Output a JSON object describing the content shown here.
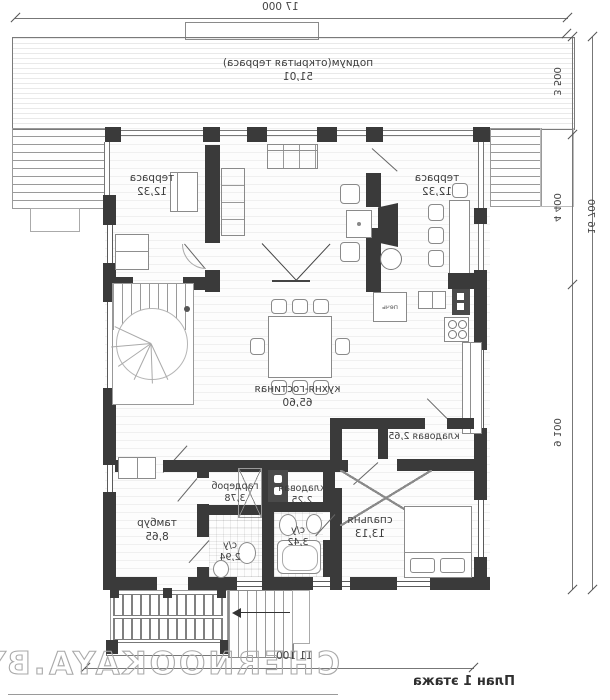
{
  "title": {
    "plan_label": "План 1 этажа"
  },
  "watermark": {
    "text": "CHERNOOKAYA.BY"
  },
  "dimensions": {
    "top_width": "17 000",
    "right_total": "16 700",
    "seg_podium": "3 500",
    "seg_terrace": "4 400",
    "seg_house": "9 100",
    "bottom_width": "11 100"
  },
  "rooms": {
    "podium": {
      "name": "подиум(открытая терраса)",
      "area": "51,01"
    },
    "terrace_left": {
      "name": "терраса",
      "area": "12,32"
    },
    "terrace_right": {
      "name": "терраса",
      "area": "12,32"
    },
    "kitchen_living": {
      "name": "кухня-гостиная",
      "area": "65,60"
    },
    "pantry_upper": {
      "name": "кладовая",
      "area": "2,65"
    },
    "bedroom": {
      "name": "спальня",
      "area": "13,13"
    },
    "pantry_small": {
      "name": "кладовая",
      "area": "2,25"
    },
    "bath_big": {
      "name": "с/у",
      "area": "3,42"
    },
    "bath_small": {
      "name": "с/у",
      "area": "2,94"
    },
    "wardrobe": {
      "name": "гардероб",
      "area": "3,78"
    },
    "vestibule": {
      "name": "тамбур",
      "area": "8,65"
    }
  },
  "equipment": {
    "stove": "печь"
  }
}
